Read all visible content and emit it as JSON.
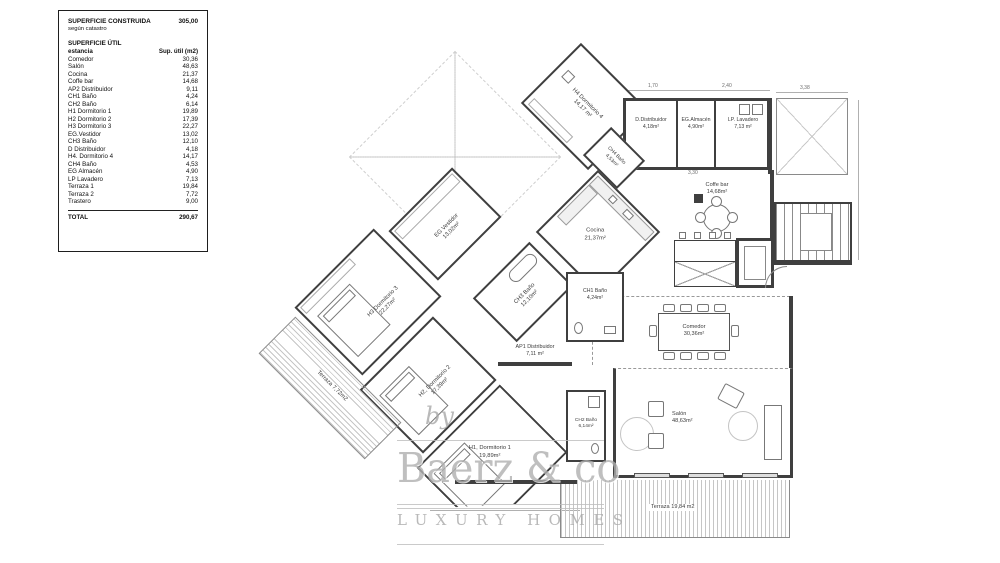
{
  "legend": {
    "constructed_label": "SUPERFICIE CONSTRUIDA",
    "constructed_value": "305,00",
    "according": "según catastro",
    "util_label": "SUPERFICIE ÚTIL",
    "col_room": "estancia",
    "col_area": "Sup. útil (m2)",
    "rows": [
      {
        "name": "Comedor",
        "value": "30,36"
      },
      {
        "name": "Salón",
        "value": "48,63"
      },
      {
        "name": "Cocina",
        "value": "21,37"
      },
      {
        "name": "Coffe bar",
        "value": "14,68"
      },
      {
        "name": "AP2 Distribuidor",
        "value": "9,11"
      },
      {
        "name": "CH1 Baño",
        "value": "4,24"
      },
      {
        "name": "CH2 Baño",
        "value": "6,14"
      },
      {
        "name": "H1 Dormitorio 1",
        "value": "19,89"
      },
      {
        "name": "H2 Dormitorio 2",
        "value": "17,39"
      },
      {
        "name": "H3 Dormitorio 3",
        "value": "22,27"
      },
      {
        "name": "EG.Vestidor",
        "value": "13,02"
      },
      {
        "name": "CH3 Baño",
        "value": "12,10"
      },
      {
        "name": "D Distribuidor",
        "value": "4,18"
      },
      {
        "name": "H4. Dormitorio 4",
        "value": "14,17"
      },
      {
        "name": "CH4 Baño",
        "value": "4,53"
      },
      {
        "name": "EG Almacén",
        "value": "4,90"
      },
      {
        "name": "LP Lavadero",
        "value": "7,13"
      },
      {
        "name": "Terraza 1",
        "value": "19,84"
      },
      {
        "name": "Terraza 2",
        "value": "7,72"
      },
      {
        "name": "Trastero",
        "value": "9,00"
      }
    ],
    "total_label": "TOTAL",
    "total_value": "290,67"
  },
  "plan": {
    "rooms": {
      "h4": {
        "name": "H4 Dormitorio 4",
        "area": "14,17 m²"
      },
      "ch4": {
        "name": "CH4 Baño",
        "area": "4,53m²"
      },
      "ddist": {
        "name": "D.Distribuidor",
        "area": "4,18m²"
      },
      "almacen": {
        "name": "EG.Almacén",
        "area": "4,90m²"
      },
      "lavadero": {
        "name": "LP. Lavadero",
        "area": "7,13 m²"
      },
      "coffebar": {
        "name": "Coffe bar",
        "area": "14,68m²"
      },
      "cocina": {
        "name": "Cocina",
        "area": "21,37m²"
      },
      "ch1": {
        "name": "CH1 Baño",
        "area": "4,24m²"
      },
      "ch2": {
        "name": "CH2 Baño",
        "area": "6,14m²"
      },
      "vestidor": {
        "name": "EG Vestidor",
        "area": "13,02m²"
      },
      "ch3": {
        "name": "CH3 Baño",
        "area": "12,10m²"
      },
      "h3": {
        "name": "H3 Dormitorio 3",
        "area": "22,27m²"
      },
      "h2": {
        "name": "H2, Dormitorio 2",
        "area": "17,39m²"
      },
      "ap1": {
        "name": "AP1 Distribuidor",
        "area": "7,11 m²"
      },
      "h1": {
        "name": "H1, Dormitorio 1",
        "area": "19,89m²"
      },
      "comedor": {
        "name": "Comedor",
        "area": "30,36m²"
      },
      "salon": {
        "name": "Salón",
        "area": "48,63m²"
      },
      "terraza1": {
        "name": "Terraza",
        "area": "19,84 m2"
      },
      "terraza2": {
        "name": "Terraza",
        "area": "7,72m2"
      }
    },
    "dims": {
      "d1": "3,38",
      "d2": "1,70",
      "d3": "2,40",
      "d4": "3,30"
    }
  },
  "watermark": {
    "by": "by",
    "brand": "Baerz & co",
    "tagline": "LUXURY HOMES"
  }
}
